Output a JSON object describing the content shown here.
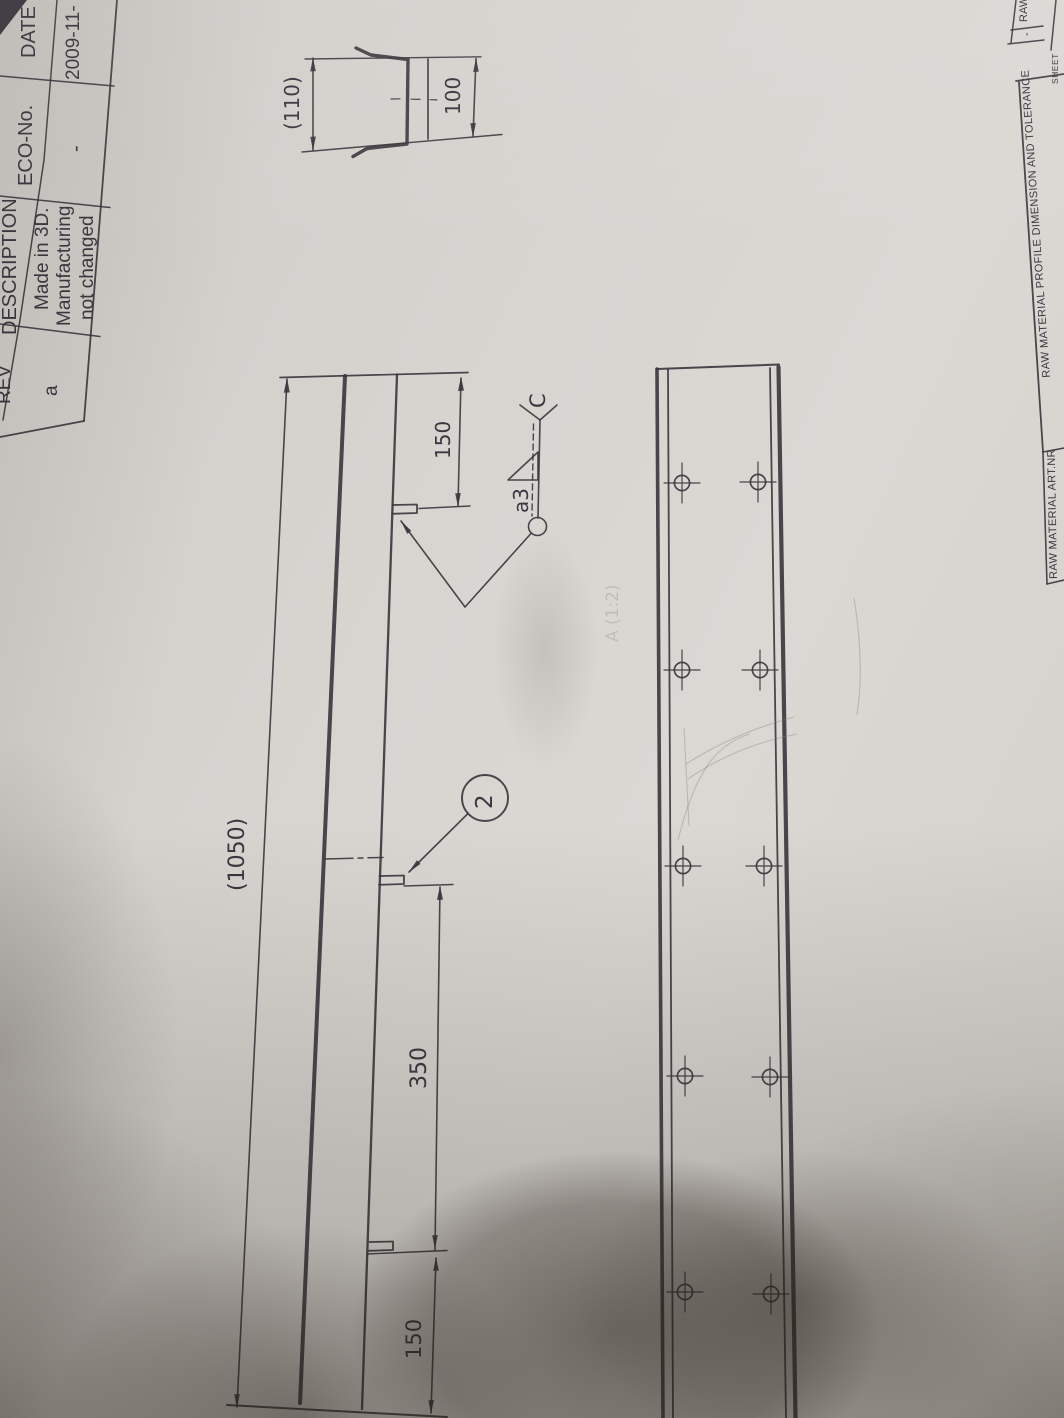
{
  "rev_table": {
    "headers": {
      "rev": "REV",
      "description": "DESCRIPTION",
      "eco_no": "ECO-No.",
      "date": "DATE"
    },
    "row": {
      "rev": "a",
      "description_lines": [
        "Made in 3D.",
        "Manufacturing",
        "not changed"
      ],
      "eco_no": "-",
      "date": "2009-11-"
    }
  },
  "title_strip": {
    "raw_label": "RAW",
    "raw_value": "-",
    "sheet_label": "SHEET",
    "profile_tolerance_label": "RAW MATERIAL PROFILE DIMENSION AND TOLERANCE",
    "art_nr_label": "RAW MATERIAL ART.NR"
  },
  "dimensions": {
    "overall_length": "(1050)",
    "hole_group_spacing": "350",
    "end_offset_top": "150",
    "end_offset_bottom": "150",
    "profile_width": "(110)",
    "profile_depth": "100"
  },
  "annotations": {
    "balloon_item": "2",
    "weld_size": "a3",
    "detail_label": "C",
    "pencil_note": "A (1:2)"
  },
  "colors": {
    "ink": "#38353c",
    "paper": "#d7d4d0",
    "shadow": "#282119"
  }
}
